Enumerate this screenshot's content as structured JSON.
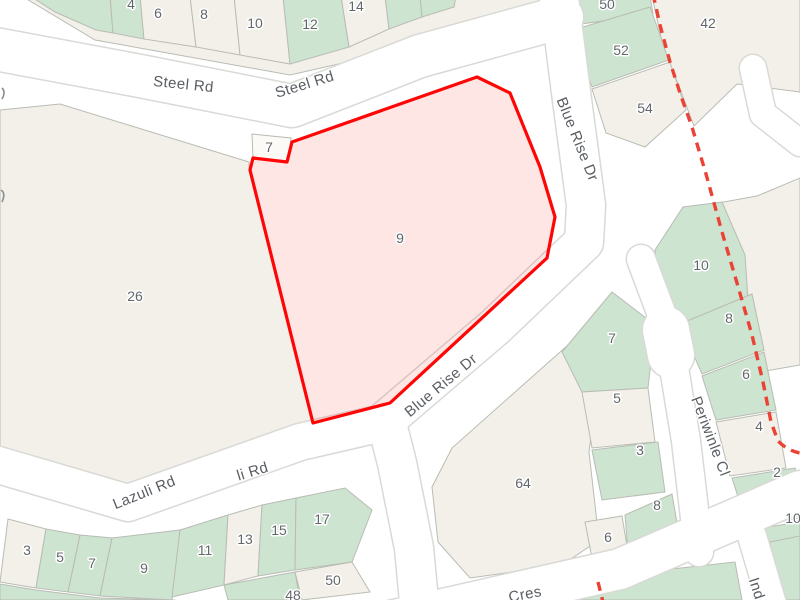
{
  "map": {
    "title": "cadastral parcel map with highlighted lot 9",
    "colors": {
      "background": "#ffffff",
      "road_fill": "#ffffff",
      "road_casing": "#d9d9d6",
      "block_beige": "#f2f0e9",
      "parcel_green": "#cce4d0",
      "parcel_stroke": "#b9bcb4",
      "number_color": "#63676b",
      "street_color": "#595d62",
      "highlight_stroke": "#ff0606",
      "highlight_fill": "rgba(240,60,50,0.13)",
      "boundary_dash": "#ea4335"
    },
    "parcels": [
      {
        "name": "block-topleft",
        "color": "b",
        "pts": "20,-5 555,-5 530,45 365,58 290,75 95,40"
      },
      {
        "name": "parcel-top-a",
        "color": "g",
        "pts": "30,-4 110,-4 113,33 96,30 55,12"
      },
      {
        "name": "parcel-top-b",
        "color": "g",
        "pts": "110,-4 140,-4 144,39 113,33"
      },
      {
        "name": "parcel-top-6",
        "color": "b",
        "pts": "140,-4 190,-4 196,47 144,39"
      },
      {
        "name": "parcel-top-8",
        "color": "b",
        "pts": "190,-4 234,-4 240,55 196,47"
      },
      {
        "name": "parcel-top-10",
        "color": "b",
        "pts": "234,-4 283,-4 290,64 240,55"
      },
      {
        "name": "parcel-top-12",
        "color": "g",
        "pts": "283,-4 341,-4 349,47 290,64"
      },
      {
        "name": "parcel-top-14",
        "color": "b",
        "pts": "341,-4 385,-4 389,29 349,47"
      },
      {
        "name": "parcel-top-16",
        "color": "g",
        "pts": "385,-4 420,-4 422,17 389,29"
      },
      {
        "name": "parcel-top-18",
        "color": "g",
        "pts": "420,-4 456,-4 454,7 422,17"
      },
      {
        "name": "block-26",
        "color": "b",
        "pts": "0,110 60,104 249,162 249,170 313,423 280,432 130,487 0,449"
      },
      {
        "name": "parcel-50",
        "color": "g",
        "pts": "577,-4 650,-4 653,14 581,24"
      },
      {
        "name": "parcel-52",
        "color": "g",
        "pts": "573,30 650,7 669,60 592,87"
      },
      {
        "name": "parcel-54",
        "color": "b",
        "pts": "592,89 670,62 686,110 645,147 606,133"
      },
      {
        "name": "parcel-42",
        "color": "b",
        "pts": "652,-4 800,-4 800,92 737,84 694,126 662,42"
      },
      {
        "name": "parcel-east-of-boundary",
        "color": "b",
        "pts": "718,203 757,196 800,178 800,365 760,372 722,235"
      },
      {
        "name": "parcel-10-east",
        "color": "g",
        "pts": "655,250 683,207 722,202 745,255 748,300 690,330 662,322"
      },
      {
        "name": "parcel-8-east",
        "color": "g",
        "pts": "680,324 752,294 764,350 702,374"
      },
      {
        "name": "parcel-6-east",
        "color": "g",
        "pts": "702,376 764,352 776,410 716,420"
      },
      {
        "name": "parcel-4-east",
        "color": "b",
        "pts": "716,422 776,412 786,468 730,476"
      },
      {
        "name": "parcel-2-east",
        "color": "g",
        "pts": "732,478 795,468 800,478 800,518 748,528"
      },
      {
        "name": "parcel-10b-east",
        "color": "g",
        "pts": "748,530 800,522 800,575 765,572"
      },
      {
        "name": "parcel-64",
        "color": "b",
        "pts": "432,487 452,448 568,345 600,368 589,452 599,540 562,565 470,578 438,542"
      },
      {
        "name": "parcel-7-west",
        "color": "g",
        "pts": "562,352 612,292 655,325 648,388 582,392"
      },
      {
        "name": "parcel-5-west",
        "color": "b",
        "pts": "582,392 648,388 655,442 592,448"
      },
      {
        "name": "parcel-3-west",
        "color": "g",
        "pts": "592,450 658,442 665,492 602,500"
      },
      {
        "name": "parcel-8b-west",
        "color": "g",
        "pts": "625,515 672,494 680,540 645,558 628,552"
      },
      {
        "name": "parcel-6b-west",
        "color": "b",
        "pts": "585,522 622,516 628,552 592,558"
      },
      {
        "name": "parcel-bot-3",
        "color": "b",
        "pts": "8,519 46,529 36,588 0,582"
      },
      {
        "name": "parcel-bot-5",
        "color": "g",
        "pts": "46,529 80,535 68,592 36,588"
      },
      {
        "name": "parcel-bot-7",
        "color": "g",
        "pts": "80,535 112,538 100,596 68,592"
      },
      {
        "name": "parcel-bot-9",
        "color": "g",
        "pts": "112,538 180,530 172,600 100,596"
      },
      {
        "name": "parcel-bot-11",
        "color": "g",
        "pts": "180,530 228,515 224,585 172,597"
      },
      {
        "name": "parcel-bot-13",
        "color": "b",
        "pts": "228,515 262,505 258,576 224,585"
      },
      {
        "name": "parcel-bot-15",
        "color": "g",
        "pts": "262,505 296,498 295,570 258,576"
      },
      {
        "name": "parcel-bot-17",
        "color": "g",
        "pts": "296,498 345,488 372,510 352,562 295,570"
      },
      {
        "name": "parcel-bot-48",
        "color": "g",
        "pts": "224,585 295,572 300,600 228,600"
      },
      {
        "name": "parcel-bot-50",
        "color": "b",
        "pts": "295,572 352,562 370,592 302,600"
      },
      {
        "name": "parcel-bot-row2",
        "color": "g",
        "pts": "0,584 36,590 100,598 175,600 0,600"
      },
      {
        "name": "parcel-cres-strip",
        "color": "g",
        "pts": "545,583 735,562 742,600 548,600"
      },
      {
        "name": "parcel-cres-right",
        "color": "g",
        "pts": "770,542 800,536 800,600 778,600"
      }
    ],
    "roads": [
      {
        "name": "steel-rd",
        "d": "M -10,48 L 140,76 L 292,106 L 420,56 L 562,17",
        "w": 42
      },
      {
        "name": "blue-rise-dr",
        "d": "M 558,-10 L 572,100 L 586,205 L 584,242 L 495,327 L 386,420 L 397,463 L 414,548 L 420,612",
        "w": 38
      },
      {
        "name": "lazuli-rd",
        "d": "M -12,462 L 128,503 L 300,442 L 378,424",
        "w": 36
      },
      {
        "name": "cres-road",
        "d": "M 368,626 L 620,569 L 800,491",
        "w": 40
      },
      {
        "name": "periwinkle-cl",
        "d": "M 641,259 L 668,331 L 686,441 L 699,552",
        "w": 28
      },
      {
        "name": "periwinkle-bulb",
        "d": "M 666,330 L 671,355",
        "w": 46
      },
      {
        "name": "ind-road",
        "d": "M 752,536 L 772,604",
        "w": 28
      },
      {
        "name": "ne-road",
        "d": "M 753,68 L 763,114 L 800,143",
        "w": 26
      }
    ],
    "highlight": {
      "name": "lot-9-selected",
      "pts": "477,77 510,93 540,167 555,217 547,258 390,403 313,423 250,170 253,158 287,162 292,142",
      "number": {
        "text": "9",
        "x": 400,
        "y": 243
      }
    },
    "annex_box": {
      "name": "lot-7-box",
      "pts": "252,134 291,138 288,162 253,158",
      "fill": "#fbfaf7"
    },
    "boundary": {
      "main": "M 653,-6 L 660,25 L 670,62 L 681,96 L 692,127 L 706,174 L 722,232 L 737,283 L 752,335 L 763,382 L 771,422 L 778,441 Q 788,451 800,453",
      "fragment": "M 598,582 L 604,606",
      "dash": "9 6.5",
      "width": 3.4
    },
    "numbers": [
      {
        "text": "4",
        "x": 131,
        "y": 9
      },
      {
        "text": "6",
        "x": 158,
        "y": 18
      },
      {
        "text": "8",
        "x": 204,
        "y": 19
      },
      {
        "text": "10",
        "x": 255,
        "y": 28
      },
      {
        "text": "12",
        "x": 310,
        "y": 29
      },
      {
        "text": "14",
        "x": 356,
        "y": 11
      },
      {
        "text": "50",
        "x": 607,
        "y": 9
      },
      {
        "text": "52",
        "x": 621,
        "y": 55
      },
      {
        "text": "54",
        "x": 645,
        "y": 113
      },
      {
        "text": "42",
        "x": 708,
        "y": 28
      },
      {
        "text": "26",
        "x": 135,
        "y": 301
      },
      {
        "text": "7",
        "x": 269,
        "y": 152
      },
      {
        "text": "10",
        "x": 701,
        "y": 270
      },
      {
        "text": "8",
        "x": 729,
        "y": 323
      },
      {
        "text": "6",
        "x": 746,
        "y": 379
      },
      {
        "text": "4",
        "x": 759,
        "y": 431
      },
      {
        "text": "2",
        "x": 777,
        "y": 477
      },
      {
        "text": "10",
        "x": 793,
        "y": 523
      },
      {
        "text": "7",
        "x": 612,
        "y": 343
      },
      {
        "text": "5",
        "x": 617,
        "y": 403
      },
      {
        "text": "3",
        "x": 640,
        "y": 455
      },
      {
        "text": "8",
        "x": 657,
        "y": 510
      },
      {
        "text": "6",
        "x": 608,
        "y": 542
      },
      {
        "text": "64",
        "x": 523,
        "y": 488
      },
      {
        "text": "3",
        "x": 27,
        "y": 555
      },
      {
        "text": "5",
        "x": 60,
        "y": 562
      },
      {
        "text": "7",
        "x": 92,
        "y": 568
      },
      {
        "text": "9",
        "x": 144,
        "y": 573
      },
      {
        "text": "11",
        "x": 205,
        "y": 555
      },
      {
        "text": "13",
        "x": 245,
        "y": 544
      },
      {
        "text": "15",
        "x": 279,
        "y": 535
      },
      {
        "text": "17",
        "x": 322,
        "y": 524
      },
      {
        "text": "48",
        "x": 293,
        "y": 600
      },
      {
        "text": "50",
        "x": 333,
        "y": 585
      }
    ],
    "street_labels": [
      {
        "text": "Steel Rd",
        "x": 183,
        "y": 89,
        "rot": 6
      },
      {
        "text": "Steel Rd",
        "x": 306,
        "y": 89,
        "rot": -17
      },
      {
        "text": "Blue Rise Dr",
        "x": 573,
        "y": 141,
        "rot": 68
      },
      {
        "text": "Blue Rise Dr",
        "x": 444,
        "y": 389,
        "rot": -40
      },
      {
        "text": "Lazuli Rd",
        "x": 146,
        "y": 497,
        "rot": -22
      },
      {
        "text": "li Rd",
        "x": 254,
        "y": 476,
        "rot": -17
      },
      {
        "text": "Periwinle Cl",
        "x": 706,
        "y": 438,
        "rot": 69
      },
      {
        "text": "Cres",
        "x": 526,
        "y": 599,
        "rot": -11
      },
      {
        "text": "Ind",
        "x": 752,
        "y": 590,
        "rot": 72
      }
    ],
    "edge_fragments": [
      "M 2,88 q 4,4 0,11",
      "M 1,190 q 5,3 1,12"
    ]
  }
}
